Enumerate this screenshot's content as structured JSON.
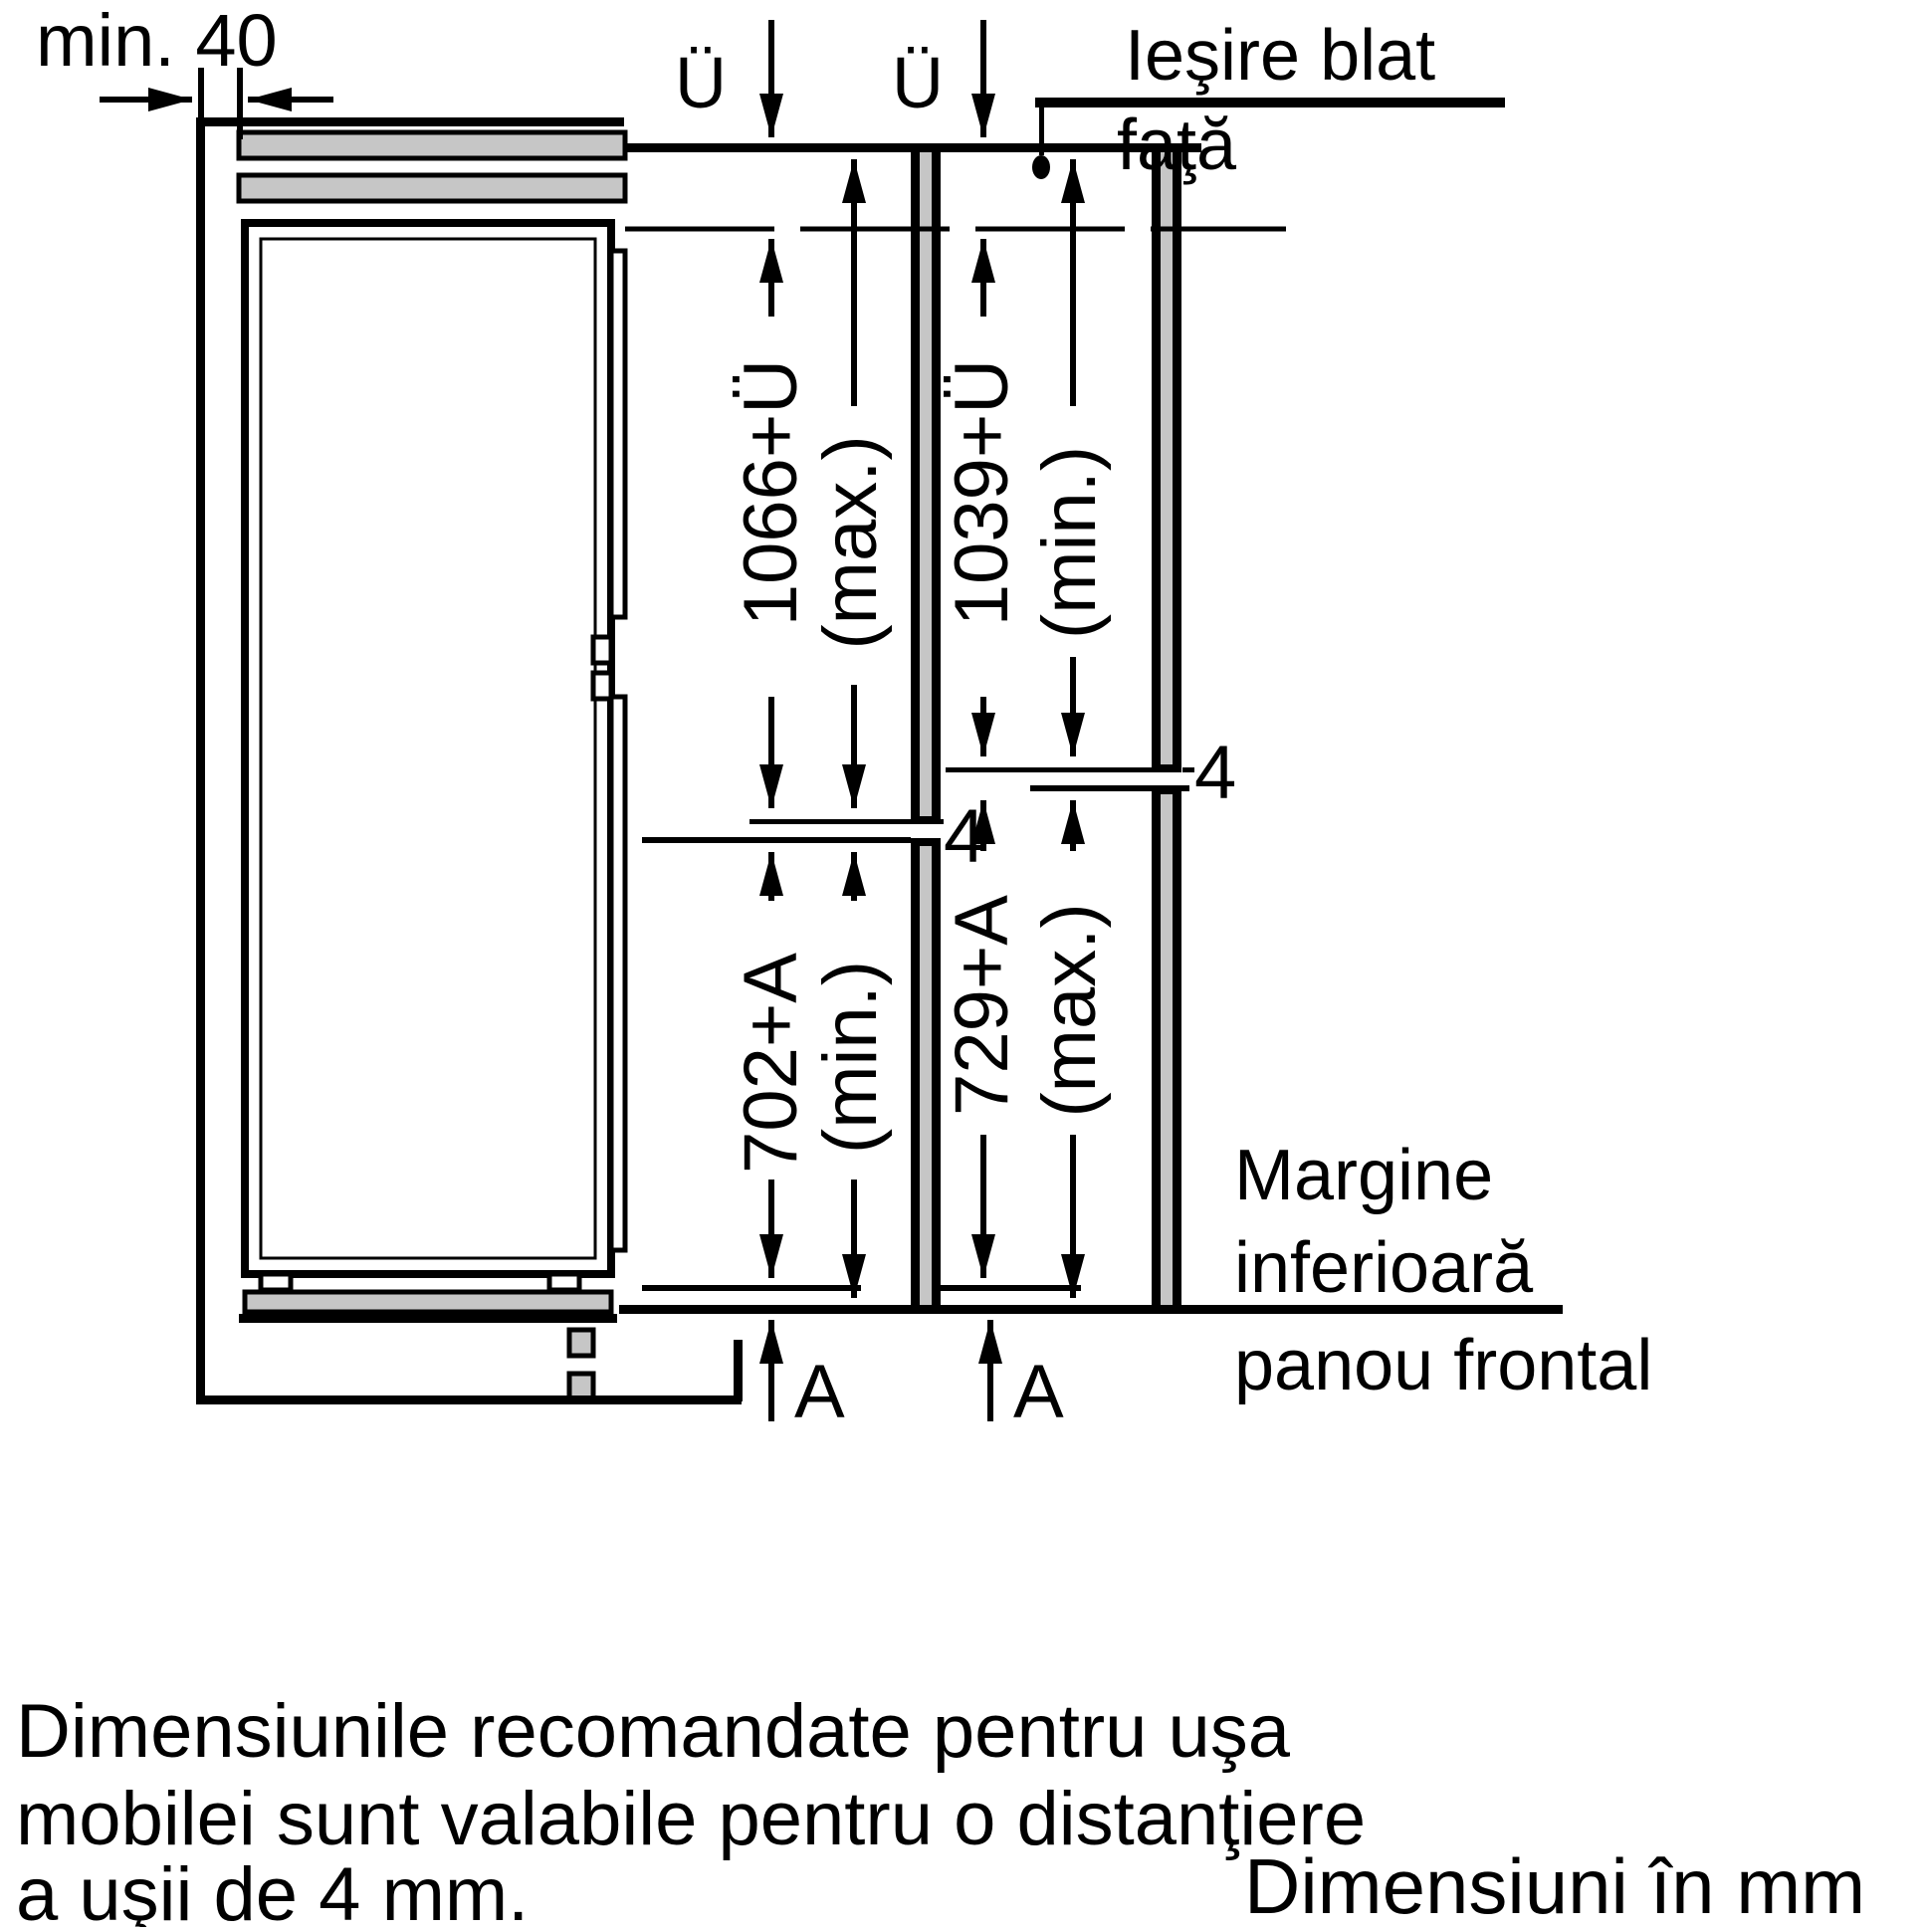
{
  "diagram": {
    "top_left_dim": "min. 40",
    "overhang_label_left": "Ü",
    "overhang_label_right": "Ü",
    "worktop_label_line1": "Ieşire blat",
    "worktop_label_line2": "faţă",
    "upper_door_left": {
      "value": "1066+Ü",
      "qualifier": "(max.)"
    },
    "upper_door_right": {
      "value": "1039+Ü",
      "qualifier": "(min.)"
    },
    "lower_door_left": {
      "value": "702+A",
      "qualifier": "(min.)"
    },
    "lower_door_right": {
      "value": "729+A",
      "qualifier": "(max.)"
    },
    "gap_left": "4",
    "gap_right": "4",
    "bottom_ref_left": "A",
    "bottom_ref_right": "A",
    "panel_edge_label": [
      "Margine",
      "inferioară",
      "panou frontal"
    ]
  },
  "footer": {
    "note_lines": [
      "Dimensiunile recomandate pentru uşa",
      "mobilei sunt valabile pentru o distanţiere",
      "a uşii de 4 mm."
    ],
    "units_note": "Dimensiuni în mm"
  },
  "colors": {
    "line": "#000000",
    "panel_gray": "#c6c6c6",
    "background": "#ffffff"
  }
}
